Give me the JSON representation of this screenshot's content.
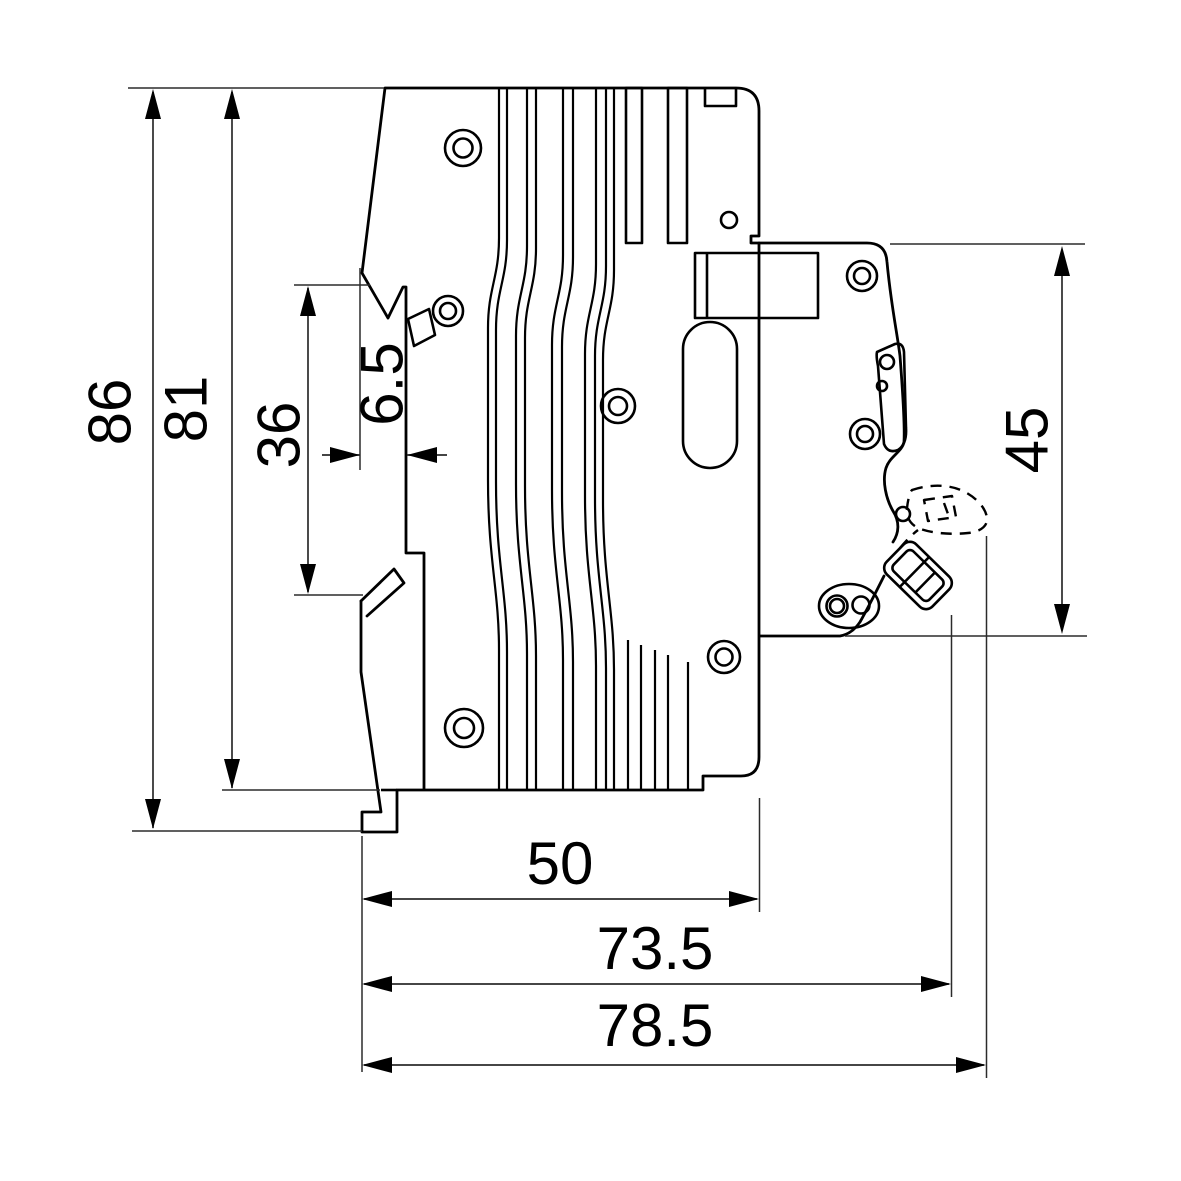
{
  "drawing": {
    "kind": "technical side-view drawing of a modular DIN-rail circuit breaker with dimension lines",
    "background": "#ffffff",
    "line_color": "#000000"
  },
  "dims": {
    "d86": "86",
    "d81": "81",
    "d36": "36",
    "d65": "6.5",
    "d45": "45",
    "d50": "50",
    "d735": "73.5",
    "d785": "78.5"
  },
  "dimension_details": [
    {
      "label": "86",
      "orientation": "vertical",
      "measures": "overall height including bottom foot"
    },
    {
      "label": "81",
      "orientation": "vertical",
      "measures": "case height to lower step"
    },
    {
      "label": "36",
      "orientation": "vertical",
      "measures": "DIN-rail channel height"
    },
    {
      "label": "6.5",
      "orientation": "horizontal",
      "measures": "DIN-rail hook depth"
    },
    {
      "label": "45",
      "orientation": "vertical",
      "measures": "front section height"
    },
    {
      "label": "50",
      "orientation": "horizontal",
      "measures": "depth of main case"
    },
    {
      "label": "73.5",
      "orientation": "horizontal",
      "measures": "depth to toggle in OFF position"
    },
    {
      "label": "78.5",
      "orientation": "horizontal",
      "measures": "depth to toggle in ON position (dashed)"
    }
  ]
}
